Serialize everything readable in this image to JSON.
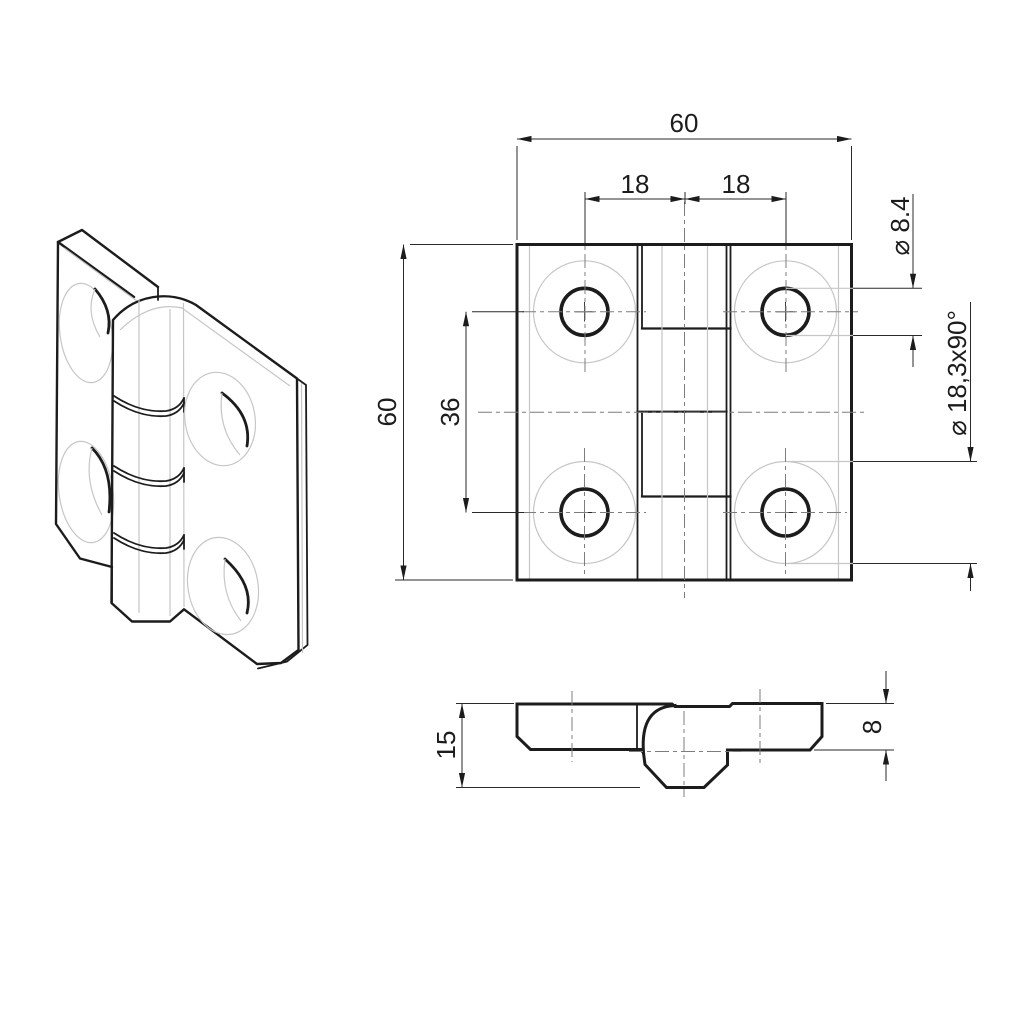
{
  "drawing": {
    "type": "technical-drawing",
    "subject": "hinge",
    "colors": {
      "background": "#ffffff",
      "outline": "#1c1c1c",
      "light_line": "#c6c6c6",
      "centerline": "#7d7d7d",
      "dimension_line": "#2a2a2a"
    },
    "views": {
      "isometric": "isometric view",
      "front": "front view",
      "side": "side view"
    }
  },
  "dimensions": {
    "overall_width": "60",
    "hole_offset_left": "18",
    "hole_offset_right": "18",
    "overall_height": "60",
    "hole_spacing_vertical": "36",
    "hole_diameter": "⌀ 8.4",
    "countersink": "⌀ 18,3x90°",
    "total_thickness": "15",
    "leaf_thickness": "8"
  }
}
